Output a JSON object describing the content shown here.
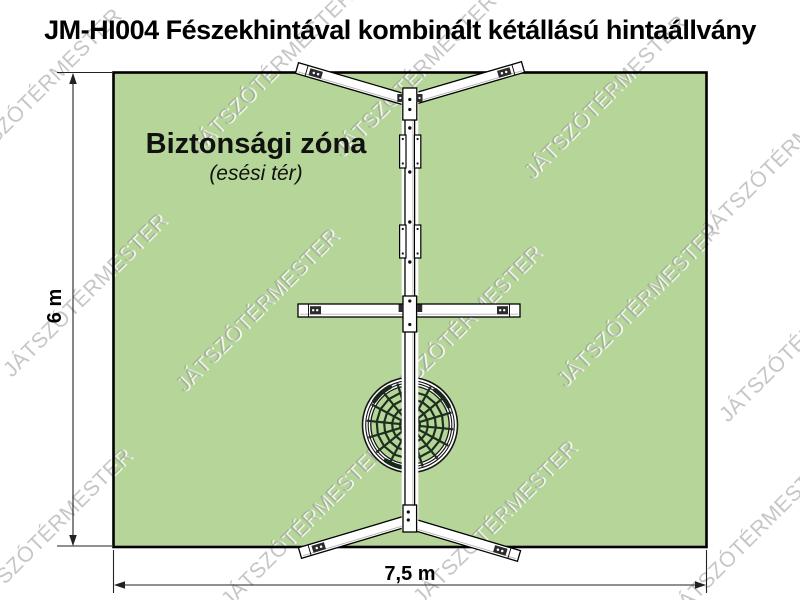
{
  "title": "JM-HI004 Fészekhintával kombinált kétállású hintaállvány",
  "safety_zone": {
    "label": "Biztonsági zóna",
    "sublabel": "(esési tér)",
    "height_label": "6 m",
    "width_label": "7,5 m",
    "fill_color": "#b6d699",
    "border_color": "#000000"
  },
  "watermark": {
    "text": "JÁTSZÓTÉRMESTER"
  }
}
